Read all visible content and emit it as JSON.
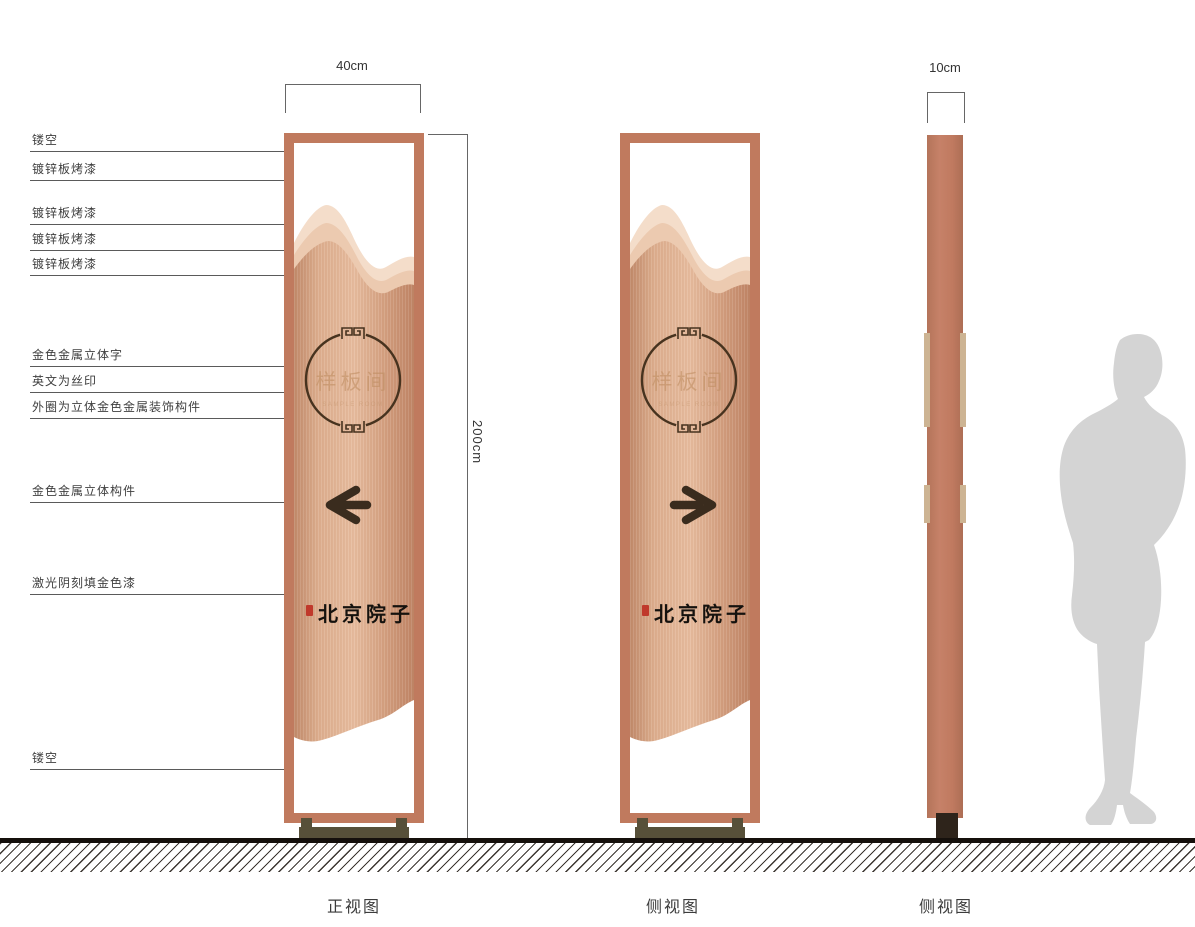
{
  "dimensions": {
    "width_label": "40cm",
    "height_label": "200cm",
    "depth_label": "10cm"
  },
  "callouts": [
    {
      "label": "镂空"
    },
    {
      "label": "镀锌板烤漆"
    },
    {
      "label": "镀锌板烤漆"
    },
    {
      "label": "镀锌板烤漆"
    },
    {
      "label": "镀锌板烤漆"
    },
    {
      "label": "金色金属立体字"
    },
    {
      "label": "英文为丝印"
    },
    {
      "label": "外圈为立体金色金属装饰构件"
    },
    {
      "label": "金色金属立体构件"
    },
    {
      "label": "激光阴刻填金色漆"
    },
    {
      "label": "镂空"
    }
  ],
  "sign": {
    "room_name": "样板间",
    "room_name_en": "SAMPLE ROOM",
    "brand_name": "北京院子"
  },
  "views": [
    {
      "caption": "正视图"
    },
    {
      "caption": "侧视图"
    },
    {
      "caption": "侧视图"
    }
  ],
  "colors": {
    "frame": "#c07a5e",
    "copper": "#d8a685",
    "mountain_light": "#f4ddca",
    "mountain_mid": "#eccab0",
    "arrow_dark": "#3a2c1e",
    "seal_red": "#c0392b",
    "base_olive": "#575039",
    "silhouette_gray": "#d4d4d4"
  }
}
